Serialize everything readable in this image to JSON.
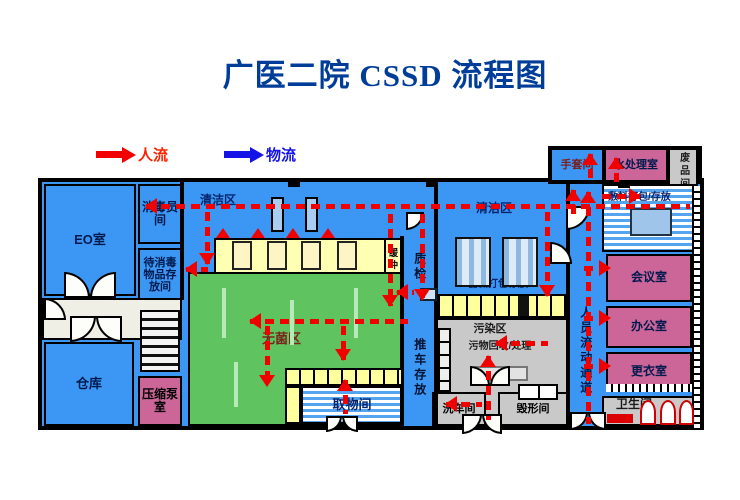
{
  "title": "广医二院 CSSD 流程图",
  "legend": {
    "people_label": "人流",
    "material_label": "物流",
    "people_color": "#ff2200",
    "material_color": "#1414e6"
  },
  "colors": {
    "title": "#003d99",
    "flow_red": "#f20000",
    "plan_blue": "#3b97f3",
    "room_pink": "#cc6699",
    "room_green": "#5fc45f",
    "room_yellow": "#ffffb3",
    "room_gray": "#c9c9c9"
  },
  "plan": {
    "rooms": [
      {
        "n": "plan-main-base",
        "l": "",
        "x": 38,
        "y": 178,
        "w": 666,
        "h": 252,
        "bg": "#3b97f3",
        "bw": 4
      },
      {
        "n": "plan-topright-base",
        "l": "",
        "x": 548,
        "y": 146,
        "w": 154,
        "h": 38,
        "bg": "#3b97f3",
        "bw": 4
      },
      {
        "n": "eo-room",
        "l": "EO室",
        "x": 44,
        "y": 184,
        "w": 92,
        "h": 112,
        "bg": "#3b97f3",
        "c": "#00194d",
        "fs": 13
      },
      {
        "n": "disinfect-staff-room",
        "l": "消毒员间",
        "x": 138,
        "y": 184,
        "w": 44,
        "h": 60,
        "bg": "#3b97f3",
        "c": "#00194d",
        "fs": 12
      },
      {
        "n": "to-disinfect-storage-room",
        "l": "待消毒物品存放间",
        "x": 138,
        "y": 248,
        "w": 44,
        "h": 54,
        "bg": "#3b97f3",
        "c": "#00194d",
        "fs": 11
      },
      {
        "n": "corridor-left",
        "l": "",
        "x": 42,
        "y": 298,
        "w": 140,
        "h": 42,
        "bg": "#f0efe6"
      },
      {
        "n": "warehouse-room",
        "l": "仓库",
        "x": 44,
        "y": 342,
        "w": 90,
        "h": 84,
        "bg": "#3b97f3",
        "c": "#00194d",
        "fs": 13
      },
      {
        "n": "compression-pump-room",
        "l": "压缩泵室",
        "x": 138,
        "y": 376,
        "w": 44,
        "h": 50,
        "bg": "#cc6699",
        "c": "#000000",
        "fs": 12
      },
      {
        "n": "clean-area-left-label",
        "l": "清洁区",
        "x": 192,
        "y": 192,
        "w": 52,
        "h": 18,
        "bg": "none",
        "nb": 1,
        "c": "#06246e",
        "fs": 12
      },
      {
        "n": "sterilizer-room",
        "l": "",
        "x": 214,
        "y": 238,
        "w": 172,
        "h": 36,
        "bg": "#ffffb3"
      },
      {
        "n": "buffer-room",
        "l": "缓冲",
        "x": 384,
        "y": 238,
        "w": 18,
        "h": 44,
        "bg": "#ffffb3",
        "c": "#000000",
        "fs": 9,
        "v": 1
      },
      {
        "n": "sterile-area",
        "l": "无菌区",
        "x": 188,
        "y": 272,
        "w": 214,
        "h": 154,
        "bg": "#5fc45f",
        "c": "#7a241c",
        "fs": 13,
        "lx": 72,
        "ly": 58
      },
      {
        "n": "pickup-room",
        "l": "取物间",
        "x": 301,
        "y": 386,
        "w": 102,
        "h": 38,
        "bg": "stripes",
        "c": "#06246e",
        "fs": 13
      },
      {
        "n": "cart-storage-corridor-label",
        "l": "推车存放",
        "x": 404,
        "y": 312,
        "w": 30,
        "h": 112,
        "bg": "none",
        "nb": 1,
        "c": "#001433",
        "fs": 12,
        "v": 1
      },
      {
        "n": "qc-corridor-label",
        "l": "质检",
        "x": 406,
        "y": 240,
        "w": 26,
        "h": 54,
        "bg": "none",
        "nb": 1,
        "c": "#001433",
        "fs": 12,
        "v": 1
      },
      {
        "n": "clean-area-right-label",
        "l": "清洁区",
        "x": 468,
        "y": 200,
        "w": 52,
        "h": 18,
        "bg": "none",
        "nb": 1,
        "c": "#06246e",
        "fs": 12
      },
      {
        "n": "instrument-pack-label",
        "l": "器械打包存放",
        "x": 448,
        "y": 278,
        "w": 100,
        "h": 14,
        "bg": "none",
        "nb": 1,
        "c": "#06246e",
        "fs": 10
      },
      {
        "n": "contaminated-area",
        "l": "",
        "x": 436,
        "y": 318,
        "w": 132,
        "h": 108,
        "bg": "#c9c9c9"
      },
      {
        "n": "contaminated-area-label",
        "l": "污染区",
        "x": 460,
        "y": 322,
        "w": 60,
        "h": 14,
        "bg": "none",
        "nb": 1,
        "c": "#1a1a1a",
        "fs": 11
      },
      {
        "n": "waste-recycle-label",
        "l": "污物回收/处理",
        "x": 448,
        "y": 340,
        "w": 104,
        "h": 13,
        "bg": "none",
        "nb": 1,
        "c": "#1a1a1a",
        "fs": 10
      },
      {
        "n": "cart-wash-room",
        "l": "洗车间",
        "x": 432,
        "y": 392,
        "w": 54,
        "h": 34,
        "bg": "#c9c9c9",
        "c": "#000000",
        "fs": 11
      },
      {
        "n": "destruction-room",
        "l": "毁形间",
        "x": 498,
        "y": 392,
        "w": 70,
        "h": 34,
        "bg": "#c9c9c9",
        "c": "#000000",
        "fs": 11
      },
      {
        "n": "personnel-corridor-label",
        "l": "人员流动通道",
        "x": 572,
        "y": 280,
        "w": 26,
        "h": 142,
        "bg": "none",
        "nb": 1,
        "c": "#00194d",
        "fs": 12,
        "v": 1
      },
      {
        "n": "glove-room",
        "l": "手套间",
        "x": 550,
        "y": 148,
        "w": 54,
        "h": 34,
        "bg": "#3b97f3",
        "c": "#7a1f1f",
        "fs": 11
      },
      {
        "n": "water-treatment-room",
        "l": "水处理室",
        "x": 604,
        "y": 148,
        "w": 64,
        "h": 34,
        "bg": "#cc6699",
        "c": "#00194d",
        "fs": 11
      },
      {
        "n": "scrap-room",
        "l": "废品间",
        "x": 668,
        "y": 148,
        "w": 30,
        "h": 46,
        "bg": "#c9c9c9",
        "c": "#1a1a1a",
        "fs": 10,
        "v": 1
      },
      {
        "n": "dressing-pack-room",
        "l": "敷料打包/存放",
        "x": 602,
        "y": 184,
        "w": 94,
        "h": 68,
        "bg": "stripes",
        "c": "#06246e",
        "fs": 10,
        "lx": 4,
        "ly": 6,
        "lw": 66
      },
      {
        "n": "meeting-room",
        "l": "会议室",
        "x": 606,
        "y": 254,
        "w": 86,
        "h": 48,
        "bg": "#cc6699",
        "c": "#00194d",
        "fs": 12
      },
      {
        "n": "office-room",
        "l": "办公室",
        "x": 606,
        "y": 306,
        "w": 86,
        "h": 42,
        "bg": "#cc6699",
        "c": "#00194d",
        "fs": 12
      },
      {
        "n": "changing-room",
        "l": "更衣室",
        "x": 606,
        "y": 352,
        "w": 86,
        "h": 40,
        "bg": "#cc6699",
        "c": "#00194d",
        "fs": 12
      },
      {
        "n": "toilet-room",
        "l": "卫生间",
        "x": 602,
        "y": 396,
        "w": 94,
        "h": 30,
        "bg": "#c9c9c9",
        "c": "#1a1a1a",
        "fs": 12,
        "lx": 12,
        "ly": 0
      }
    ],
    "walls": [
      {
        "x": 400,
        "y": 236,
        "w": 4,
        "h": 190
      },
      {
        "x": 434,
        "y": 182,
        "w": 4,
        "h": 244
      },
      {
        "x": 566,
        "y": 182,
        "w": 4,
        "h": 248
      },
      {
        "x": 180,
        "y": 182,
        "w": 4,
        "h": 118
      },
      {
        "x": 288,
        "y": 178,
        "w": 12,
        "h": 9
      },
      {
        "x": 426,
        "y": 178,
        "w": 12,
        "h": 9
      },
      {
        "x": 618,
        "y": 180,
        "w": 12,
        "h": 8
      }
    ],
    "fixtures": [
      {
        "t": "mach",
        "x": 271,
        "y": 197,
        "w": 13,
        "h": 35
      },
      {
        "t": "mach",
        "x": 305,
        "y": 197,
        "w": 13,
        "h": 35
      },
      {
        "t": "sdoor",
        "x": 232,
        "y": 241,
        "w": 20,
        "h": 29
      },
      {
        "t": "sdoor",
        "x": 267,
        "y": 241,
        "w": 20,
        "h": 29
      },
      {
        "t": "sdoor",
        "x": 301,
        "y": 241,
        "w": 20,
        "h": 29
      },
      {
        "t": "sdoor",
        "x": 337,
        "y": 241,
        "w": 20,
        "h": 29
      },
      {
        "t": "tri",
        "x": 216,
        "y": 228,
        "w": 14,
        "h": 10
      },
      {
        "t": "tri",
        "x": 251,
        "y": 228,
        "w": 14,
        "h": 10
      },
      {
        "t": "tri",
        "x": 286,
        "y": 228,
        "w": 14,
        "h": 10
      },
      {
        "t": "tri",
        "x": 321,
        "y": 228,
        "w": 14,
        "h": 10
      },
      {
        "t": "wash",
        "x": 455,
        "y": 237,
        "w": 36,
        "h": 50
      },
      {
        "t": "wash",
        "x": 502,
        "y": 237,
        "w": 36,
        "h": 50
      },
      {
        "t": "rack",
        "x": 222,
        "y": 288,
        "w": 4,
        "h": 50
      },
      {
        "t": "rack",
        "x": 290,
        "y": 300,
        "w": 4,
        "h": 45
      },
      {
        "t": "rack",
        "x": 354,
        "y": 288,
        "w": 4,
        "h": 50
      },
      {
        "t": "rack",
        "x": 234,
        "y": 362,
        "w": 4,
        "h": 45
      },
      {
        "t": "stairs",
        "x": 140,
        "y": 310,
        "w": 40,
        "h": 62
      },
      {
        "t": "cellrow",
        "x": 285,
        "y": 368,
        "w": 118,
        "h": 18
      },
      {
        "t": "ycell",
        "x": 285,
        "y": 386,
        "w": 16,
        "h": 38
      },
      {
        "t": "cellrow",
        "x": 438,
        "y": 294,
        "w": 130,
        "h": 24
      },
      {
        "t": "blackcell",
        "x": 518,
        "y": 296,
        "w": 11,
        "h": 20
      },
      {
        "t": "btable",
        "x": 420,
        "y": 288,
        "w": 17,
        "h": 13
      },
      {
        "t": "gtable",
        "x": 474,
        "y": 366,
        "w": 54,
        "h": 15
      },
      {
        "t": "lockers",
        "x": 438,
        "y": 328,
        "w": 13,
        "h": 64
      },
      {
        "t": "counter",
        "x": 518,
        "y": 384,
        "w": 40,
        "h": 16
      },
      {
        "t": "btable2",
        "x": 630,
        "y": 208,
        "w": 42,
        "h": 28
      },
      {
        "t": "vticks",
        "x": 692,
        "y": 186,
        "w": 10,
        "h": 242
      },
      {
        "t": "hticks",
        "x": 606,
        "y": 384,
        "w": 86,
        "h": 8
      },
      {
        "t": "stall",
        "x": 640,
        "y": 400,
        "w": 16,
        "h": 25
      },
      {
        "t": "stall",
        "x": 660,
        "y": 400,
        "w": 16,
        "h": 25
      },
      {
        "t": "stall",
        "x": 679,
        "y": 400,
        "w": 15,
        "h": 25
      },
      {
        "t": "redsign",
        "x": 607,
        "y": 414,
        "w": 26,
        "h": 9
      }
    ],
    "doors": [
      {
        "x": 64,
        "y": 272,
        "s": 26,
        "c": "tr"
      },
      {
        "x": 90,
        "y": 272,
        "s": 26,
        "c": "tl"
      },
      {
        "x": 70,
        "y": 316,
        "s": 26,
        "c": "br"
      },
      {
        "x": 96,
        "y": 316,
        "s": 26,
        "c": "bl"
      },
      {
        "x": 44,
        "y": 298,
        "s": 22,
        "c": "tr"
      },
      {
        "x": 326,
        "y": 416,
        "s": 16,
        "c": "br"
      },
      {
        "x": 342,
        "y": 416,
        "s": 16,
        "c": "bl"
      },
      {
        "x": 470,
        "y": 366,
        "s": 20,
        "c": "tr"
      },
      {
        "x": 490,
        "y": 366,
        "s": 20,
        "c": "tl"
      },
      {
        "x": 462,
        "y": 414,
        "s": 20,
        "c": "br"
      },
      {
        "x": 482,
        "y": 414,
        "s": 20,
        "c": "bl"
      },
      {
        "x": 570,
        "y": 412,
        "s": 18,
        "c": "br"
      },
      {
        "x": 588,
        "y": 412,
        "s": 18,
        "c": "bl"
      },
      {
        "x": 566,
        "y": 206,
        "s": 24,
        "c": "br"
      },
      {
        "x": 550,
        "y": 242,
        "s": 22,
        "c": "tr"
      },
      {
        "x": 406,
        "y": 212,
        "s": 18,
        "c": "br"
      }
    ],
    "arrows": [
      [
        690,
        206,
        146,
        206
      ],
      [
        207,
        212,
        207,
        264
      ],
      [
        208,
        269,
        186,
        269
      ],
      [
        390,
        214,
        390,
        306
      ],
      [
        422,
        214,
        422,
        300
      ],
      [
        414,
        292,
        397,
        292
      ],
      [
        408,
        321,
        250,
        321
      ],
      [
        267,
        326,
        267,
        386
      ],
      [
        343,
        326,
        343,
        360
      ],
      [
        345,
        414,
        345,
        380
      ],
      [
        547,
        212,
        547,
        296
      ],
      [
        548,
        343,
        496,
        343
      ],
      [
        488,
        420,
        488,
        356
      ],
      [
        482,
        404,
        446,
        404
      ],
      [
        588,
        424,
        588,
        192
      ],
      [
        584,
        268,
        610,
        268
      ],
      [
        584,
        318,
        610,
        318
      ],
      [
        584,
        366,
        610,
        366
      ],
      [
        590,
        180,
        590,
        154
      ],
      [
        616,
        182,
        616,
        158
      ],
      [
        602,
        196,
        640,
        196
      ],
      [
        573,
        214,
        573,
        190
      ]
    ]
  }
}
